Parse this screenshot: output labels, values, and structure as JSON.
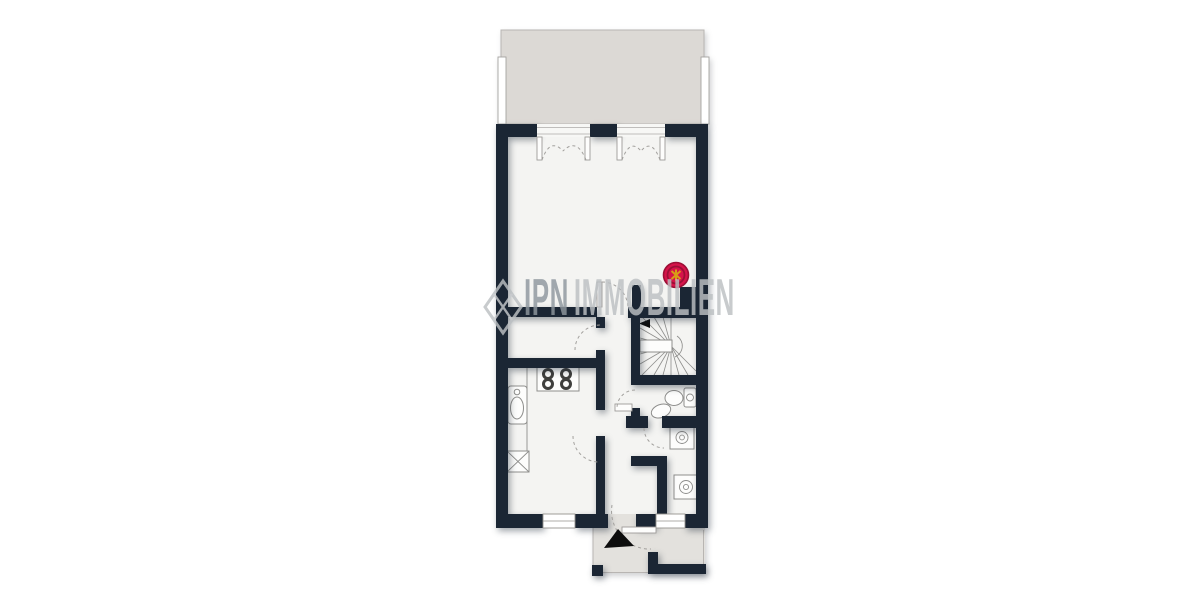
{
  "watermark": {
    "brand_primary": "IPN",
    "brand_secondary": "IMMOBILIEN"
  },
  "colors": {
    "wall": "#1b2634",
    "room": "#f4f4f2",
    "terrace": "#dcd9d5",
    "porch": "#e3e1dd",
    "line": "#8e8e8c",
    "thin_line": "#b8b5b2",
    "dash": "#a2a09d",
    "marker_red": "#d6134a",
    "marker_ring": "#9b0f35",
    "marker_star": "#d89d17",
    "watermark_primary": "#8e979e",
    "watermark_secondary": "#bcc0c3"
  }
}
